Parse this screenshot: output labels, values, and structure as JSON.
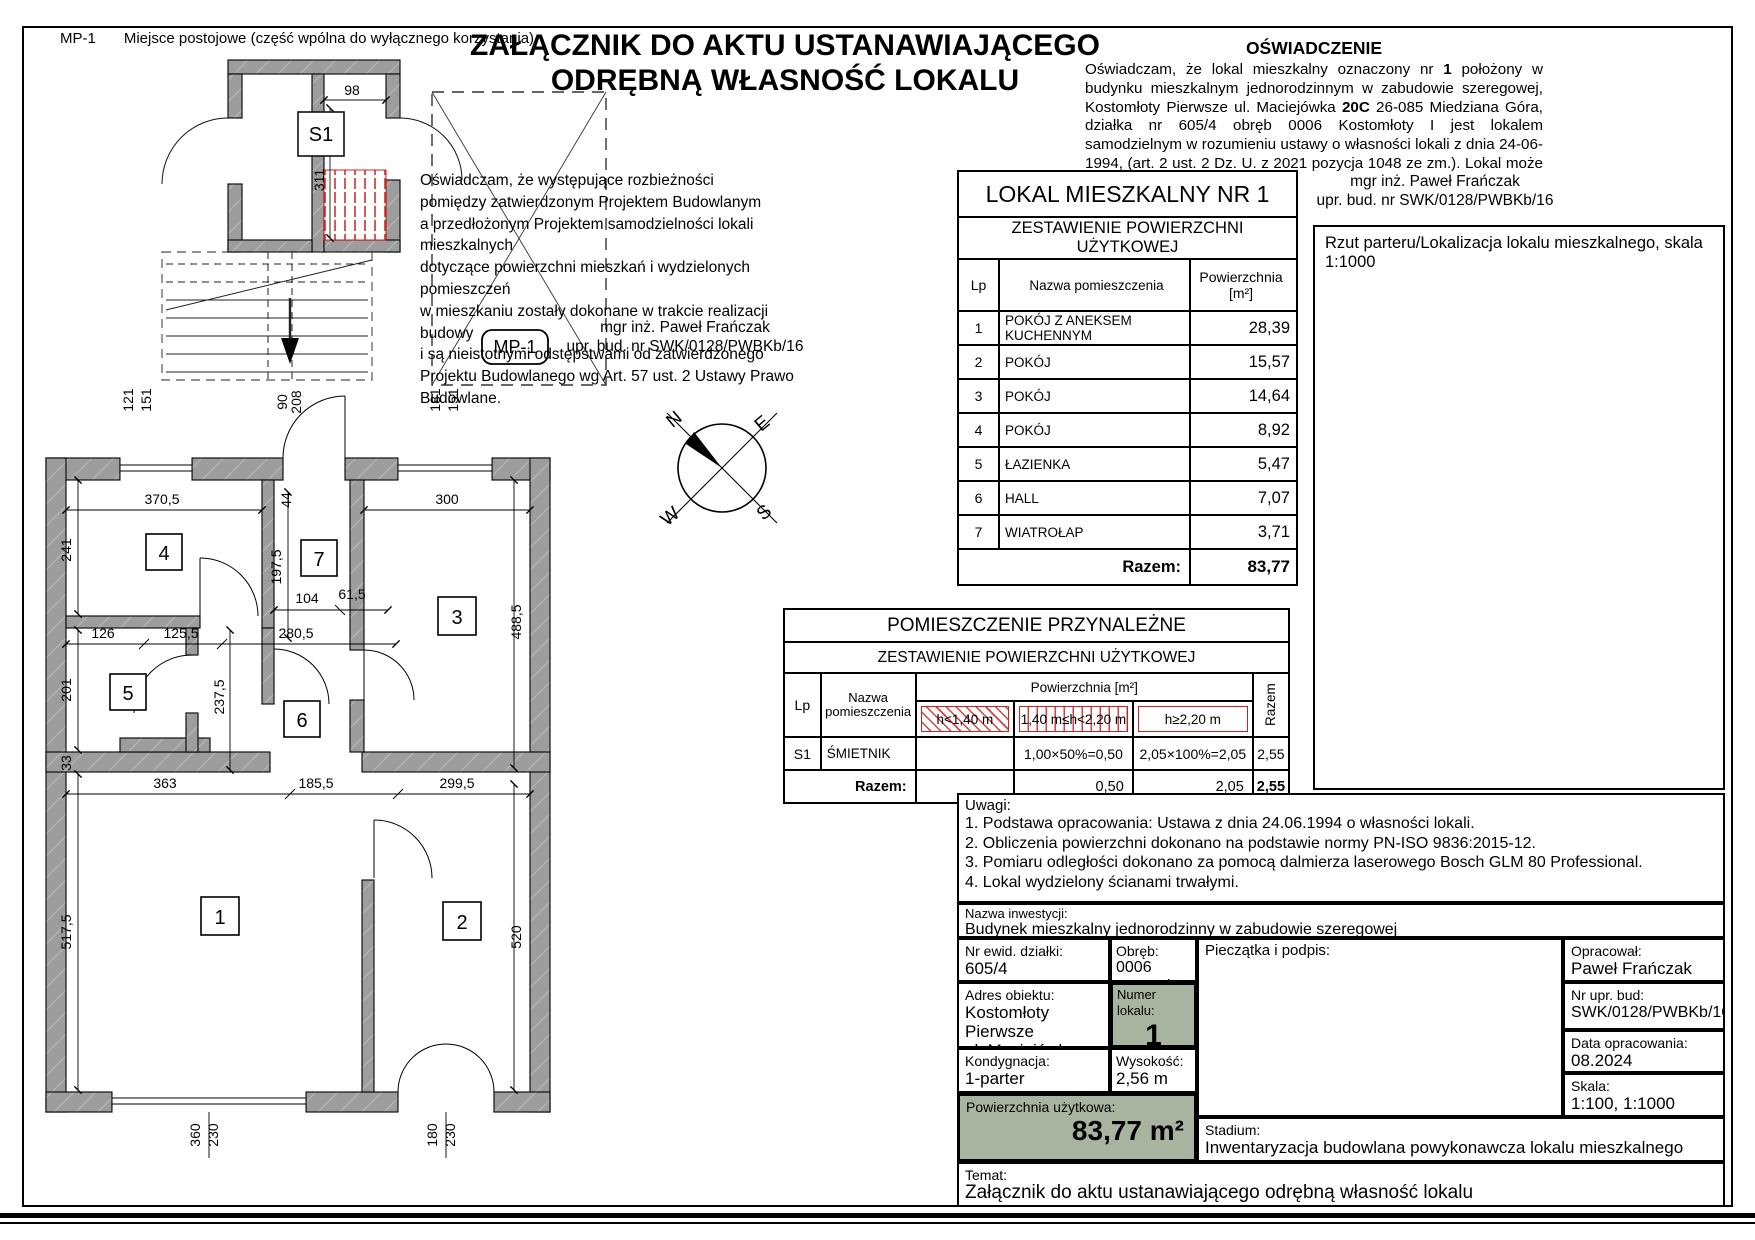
{
  "page": {
    "corner_code": "MP-1",
    "corner_note": "Miejsce postojowe (część wpólna do wyłącznego korzystania)",
    "title_line1": "ZAŁĄCZNIK DO AKTU USTANAWIAJĄCEGO",
    "title_line2": "ODRĘBNĄ WŁASNOŚĆ LOKALU"
  },
  "oswiadczenie": {
    "heading": "OŚWIADCZENIE",
    "body_parts": [
      "Oświadczam, że lokal mieszkalny oznaczony nr ",
      "1",
      " położony w budynku mieszkalnym jednorodzinnym w zabudowie szeregowej, Kostomłoty Pierwsze ul. Maciejówka ",
      "20C",
      " 26-085 Miedziana Góra, działka nr 605/4 obręb 0006 Kostomłoty I jest lokalem samodzielnym w rozumieniu ustawy o własności lokali z dnia 24-06-1994, (art. 2 ust. 2 Dz. U. z 2021 pozycja 1048 ze zm.). Lokal może służyć swojemu przeznaczeniu."
    ],
    "signature_name": "mgr inż. Paweł Frańczak",
    "signature_cred": "upr. bud. nr SWK/0128/PWBKb/16"
  },
  "statement": {
    "lines": [
      "Oświadczam, że występujące rozbieżności",
      "pomiędzy zatwierdzonym Projektem Budowlanym",
      "a przedłożonym Projektem samodzielności lokali mieszkalnych",
      "dotyczące powierzchni mieszkań i wydzielonych pomieszczeń",
      "w mieszkaniu zostały dokonane w trakcie realizacji budowy",
      "i są nieistotnymi odstępstwami od zatwierdzonego",
      "Projektu Budowlanego wg Art. 57 ust. 2 Ustawy Prawo Budowlane."
    ],
    "signature_name": "mgr inż. Paweł Frańczak",
    "signature_cred": "upr. bud. nr SWK/0128/PWBKb/16"
  },
  "lokal_table": {
    "title": "LOKAL MIESZKALNY NR 1",
    "subtitle": "ZESTAWIENIE POWIERZCHNI UŻYTKOWEJ",
    "col_lp": "Lp",
    "col_name": "Nazwa pomieszczenia",
    "col_area1": "Powierzchnia",
    "col_area2": "[m²]",
    "rows": [
      {
        "lp": "1",
        "name": "POKÓJ Z ANEKSEM KUCHENNYM",
        "area": "28,39"
      },
      {
        "lp": "2",
        "name": "POKÓJ",
        "area": "15,57"
      },
      {
        "lp": "3",
        "name": "POKÓJ",
        "area": "14,64"
      },
      {
        "lp": "4",
        "name": "POKÓJ",
        "area": "8,92"
      },
      {
        "lp": "5",
        "name": "ŁAZIENKA",
        "area": "5,47"
      },
      {
        "lp": "6",
        "name": "HALL",
        "area": "7,07"
      },
      {
        "lp": "7",
        "name": "WIATROŁAP",
        "area": "3,71"
      }
    ],
    "total_label": "Razem:",
    "total": "83,77"
  },
  "przynalezne_table": {
    "title": "POMIESZCZENIE PRZYNALEŻNE",
    "subtitle": "ZESTAWIENIE POWIERZCHNI UŻYTKOWEJ",
    "col_lp": "Lp",
    "col_name1": "Nazwa",
    "col_name2": "pomieszczenia",
    "col_group": "Powierzchnia [m²]",
    "col_h1": "h<1,40 m",
    "col_h2": "1,40 m≤h<2,20 m",
    "col_h3": "h≥2,20 m",
    "col_razem": "Razem",
    "row": {
      "lp": "S1",
      "name": "ŚMIETNIK",
      "h1": "",
      "h2": "1,00×50%=0,50",
      "h3": "2,05×100%=2,05",
      "razem": "2,55"
    },
    "total_label": "Razem:",
    "total_h1": "",
    "total_h2": "0,50",
    "total_h3": "2,05",
    "total": "2,55"
  },
  "location": {
    "header": "Rzut parteru/Lokalizacja lokalu mieszkalnego, skala 1:1000",
    "street": "ul. Maciejówka"
  },
  "compass": {
    "n": "N",
    "e": "E",
    "w": "W",
    "s": "S"
  },
  "uwagi": {
    "heading": "Uwagi:",
    "items": [
      "1. Podstawa opracowania: Ustawa z dnia 24.06.1994 o własności lokali.",
      "2. Obliczenia powierzchni dokonano na podstawie normy PN-ISO 9836:2015-12.",
      "3. Pomiaru odległości dokonano za pomocą dalmierza laserowego Bosch GLM 80 Professional.",
      "4. Lokal wydzielony ścianami trwałymi."
    ]
  },
  "info": {
    "nazwa_label": "Nazwa inwestycji:",
    "nazwa": "Budynek mieszkalny jednorodzinny w zabudowie szeregowej",
    "dzialka_label": "Nr ewid. działki:",
    "dzialka": "605/4",
    "obreb_label": "Obręb:",
    "obreb_nr": "0006",
    "obreb_name": "Kostomłoty I",
    "pieczatka_label": "Pieczątka i podpis:",
    "opracowal_label": "Opracował:",
    "opracowal": "Paweł Frańczak",
    "adres_label": "Adres obiektu:",
    "adres1": "Kostomłoty Pierwsze",
    "adres2": "ul. Maciejówka 20C",
    "numer_label": "Numer lokalu:",
    "numer": "1",
    "upr_label": "Nr upr. bud:",
    "upr": "SWK/0128/PWBKb/16",
    "kond_label": "Kondygnacja:",
    "kond": "1-parter",
    "wys_label": "Wysokość:",
    "wys": "2,56 m",
    "data_label": "Data opracowania:",
    "data": "08.2024",
    "pow_label": "Powierzchnia użytkowa:",
    "pow": "83,77 m²",
    "skala_label": "Skala:",
    "skala": "1:100, 1:1000",
    "stadium_label": "Stadium:",
    "stadium": "Inwentaryzacja budowlana powykonawcza lokalu mieszkalnego",
    "temat_label": "Temat:",
    "temat": "Załącznik do aktu ustanawiającego odrębną własność lokalu"
  },
  "plan": {
    "s1": "S1",
    "mp1": "MP-1",
    "rooms": {
      "r1": "1",
      "r2": "2",
      "r3": "3",
      "r4": "4",
      "r5": "5",
      "r6": "6",
      "r7": "7"
    },
    "dims": {
      "d98": "98",
      "d311": "311",
      "d121": "121",
      "d151a": "151",
      "d90": "90",
      "d208": "208",
      "d181": "181",
      "d151b": "151",
      "d370": "370,5",
      "d300": "300",
      "d44": "44",
      "d241": "241",
      "d197": "197,5",
      "d104": "104",
      "d61": "61,5",
      "d488": "488,5",
      "d126": "126",
      "d125": "125,5",
      "d280": "280,5",
      "d201": "201",
      "d237": "237,5",
      "d33": "33",
      "d363": "363",
      "d185": "185,5",
      "d299": "299,5",
      "d517": "517,5",
      "d520": "520",
      "d360": "360",
      "d230a": "230",
      "d180": "180",
      "d230b": "230"
    }
  },
  "colors": {
    "wall": "#9d9d9d",
    "red": "#cc2222",
    "sage": "#a9b4a0"
  }
}
